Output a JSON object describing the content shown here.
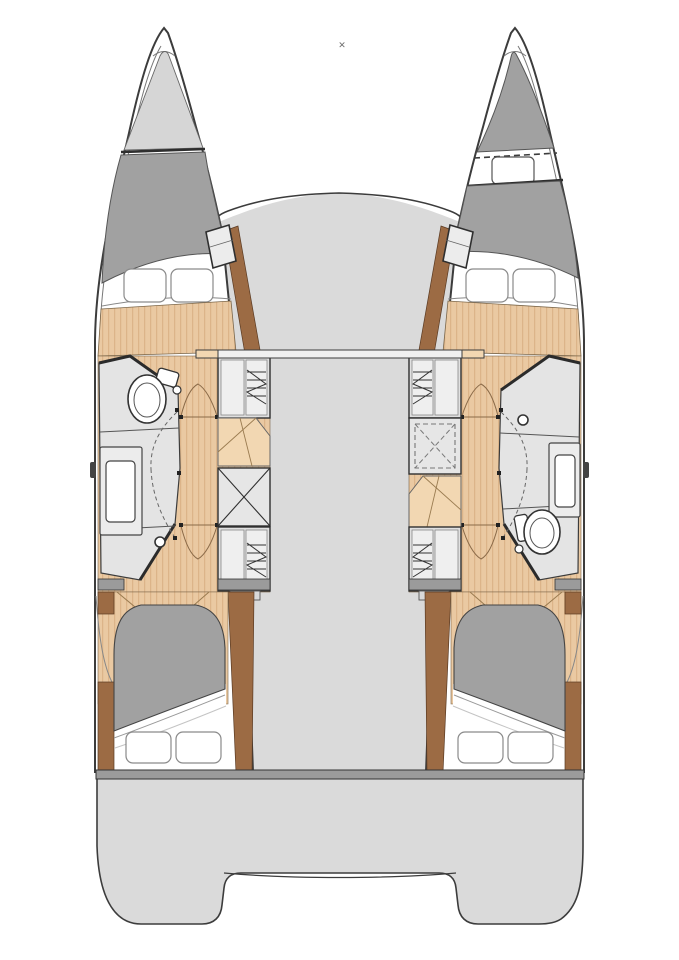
{
  "marker": {
    "glyph": "✕"
  },
  "palette": {
    "ink": "#3c3c3c",
    "deck": "#dadada",
    "deck-dark": "#9b9b9b",
    "shade": "#a1a1a1",
    "locker": "#d6d6d6",
    "room": "#e4e4e4",
    "box": "#e0e0e0",
    "panel": "#efefef",
    "trim": "#9c6b44",
    "wood": "#eac9a2",
    "wood-stripe": "#dcb489",
    "wood-light": "#f2d7b2",
    "paper": "#ffffff"
  },
  "plan": {
    "type": "catamaran-floor-plan",
    "regions": [
      "port-bow-locker",
      "port-forward-cabin",
      "port-bathroom",
      "port-aft-cabin",
      "starboard-bow-berth",
      "starboard-forward-cabin",
      "starboard-bathroom",
      "starboard-aft-cabin",
      "bridge-deck",
      "mast-beam",
      "stern-platform"
    ],
    "fixtures": [
      "toilet",
      "sink-vanity",
      "shower-drain",
      "wardrobe",
      "storage-box",
      "stairs",
      "double-berth",
      "pillows",
      "deck-hatch"
    ]
  }
}
